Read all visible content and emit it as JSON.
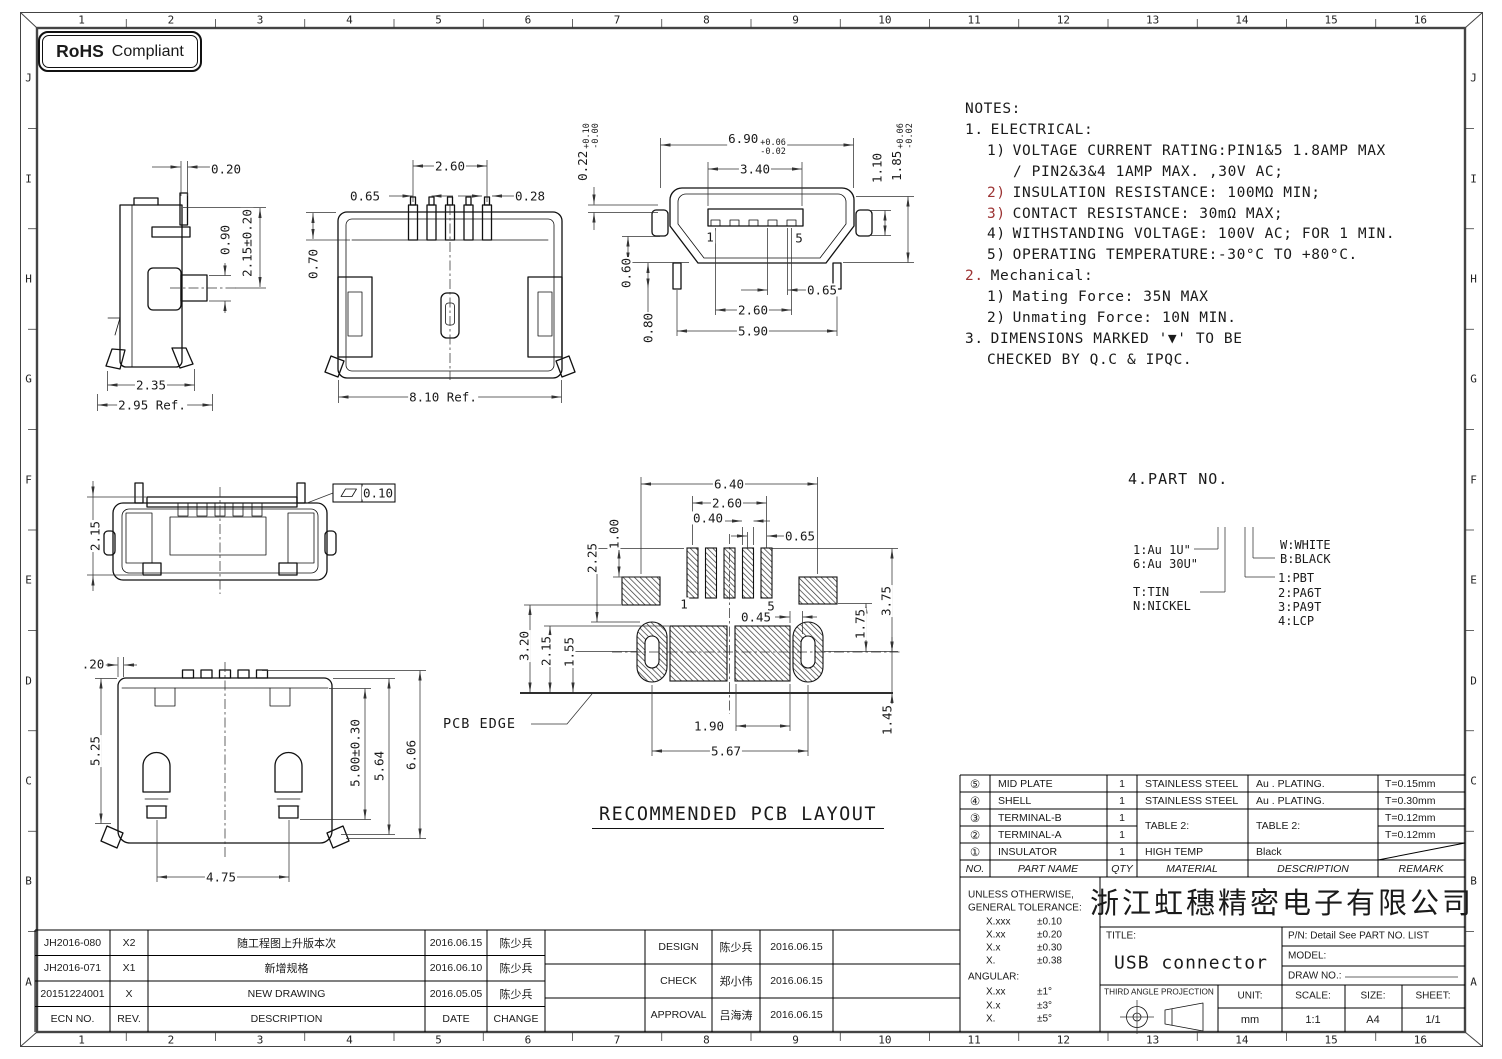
{
  "badge": {
    "brand": "RoHS",
    "label": "Compliant"
  },
  "grid": {
    "cols": [
      "1",
      "2",
      "3",
      "4",
      "5",
      "6",
      "7",
      "8",
      "9",
      "10",
      "11",
      "12",
      "13",
      "14",
      "15",
      "16"
    ],
    "rows": [
      "J",
      "I",
      "H",
      "G",
      "F",
      "E",
      "D",
      "C",
      "B",
      "A"
    ]
  },
  "notes": {
    "title": "NOTES:",
    "lines": [
      {
        "num": "1.",
        "text": "ELECTRICAL:"
      },
      {
        "num": "1)",
        "text": "VOLTAGE CURRENT RATING:PIN1&5 1.8AMP MAX"
      },
      {
        "num": "",
        "text": "/ PIN2&3&4 1AMP MAX. ,30V AC;"
      },
      {
        "num": "2)",
        "text": "INSULATION RESISTANCE: 100MΩ MIN;"
      },
      {
        "num": "3)",
        "text": "CONTACT RESISTANCE: 30mΩ MAX;"
      },
      {
        "num": "4)",
        "text": "WITHSTANDING VOLTAGE: 100V AC; FOR 1 MIN."
      },
      {
        "num": "5)",
        "text": "OPERATING TEMPERATURE:-30°C TO +80°C."
      },
      {
        "num": "2.",
        "text": "Mechanical:"
      },
      {
        "num": "1)",
        "text": "Mating Force:  35N MAX"
      },
      {
        "num": "2)",
        "text": "Unmating Force:  10N MIN."
      },
      {
        "num": "3.",
        "text": "DIMENSIONS MARKED '▼' TO BE"
      },
      {
        "num": "",
        "text": "CHECKED BY Q.C & IPQC."
      }
    ]
  },
  "legend": {
    "title": "4.PART NO.",
    "items_plating": [
      "1:Au 1U\"",
      "6:Au 30U\""
    ],
    "items_base": [
      "T:TIN",
      "N:NICKEL"
    ],
    "items_color": [
      "W:WHITE",
      "B:BLACK"
    ],
    "items_insulator": [
      "1:PBT",
      "2:PA6T",
      "3:PA9T",
      "4:LCP"
    ]
  },
  "pcb_title": "RECOMMENDED PCB LAYOUT",
  "dims": {
    "side": {
      "d020": "0.20",
      "d090": "0.90",
      "d215": "2.15±0.20",
      "d235": "2.35",
      "d295": "2.95 Ref."
    },
    "top": {
      "d260": "2.60",
      "d065": "0.65",
      "d028": "0.28",
      "d070": "0.70",
      "d810": "8.10 Ref."
    },
    "front": {
      "d022": "0.22",
      "d022p": "+0.10",
      "d022m": "-0.00",
      "d690": "6.90",
      "d690p": "+0.06",
      "d690m": "-0.02",
      "d340": "3.40",
      "d110": "1.10",
      "d185": "1.85",
      "d185p": "+0.06",
      "d185m": "-0.02",
      "d060": "0.60",
      "d080": "0.80",
      "d065": "0.65",
      "d260": "2.60",
      "d590": "5.90",
      "pin1": "1",
      "pin5": "5"
    },
    "rear": {
      "d215": "2.15",
      "tol": "0.10"
    },
    "pcb": {
      "d640": "6.40",
      "d260": "2.60",
      "d040": "0.40",
      "d065": "0.65",
      "d100": "1.00",
      "d225": "2.25",
      "d320": "3.20",
      "d215": "2.15",
      "d155": "1.55",
      "d045": "0.45",
      "d175": "1.75",
      "d375": "3.75",
      "d145": "1.45",
      "d190": "1.90",
      "d567": "5.67",
      "pin1": "1",
      "pin5": "5",
      "edge_label": "PCB EDGE"
    },
    "bottom": {
      "d020": ".20",
      "d525": "5.25",
      "d500": "5.00±0.30",
      "d564": "5.64",
      "d606": "6.06",
      "d475": "4.75"
    }
  },
  "parts_table": {
    "headers": {
      "no": "NO.",
      "name": "PART NAME",
      "qty": "QTY",
      "material": "MATERIAL",
      "desc": "DESCRIPTION",
      "remark": "REMARK"
    },
    "merged_material": "TABLE 2:",
    "merged_desc": "TABLE 2:",
    "rows": [
      {
        "no": "⑤",
        "name": "MID PLATE",
        "qty": "1",
        "material": "STAINLESS STEEL",
        "desc": "Au . PLATING.",
        "remark": "T=0.15mm"
      },
      {
        "no": "④",
        "name": "SHELL",
        "qty": "1",
        "material": "STAINLESS STEEL",
        "desc": "Au . PLATING.",
        "remark": "T=0.30mm"
      },
      {
        "no": "③",
        "name": "TERMINAL-B",
        "qty": "1",
        "material": "",
        "desc": "",
        "remark": "T=0.12mm"
      },
      {
        "no": "②",
        "name": "TERMINAL-A",
        "qty": "1",
        "material": "",
        "desc": "",
        "remark": "T=0.12mm"
      },
      {
        "no": "①",
        "name": "INSULATOR",
        "qty": "1",
        "material": "HIGH TEMP",
        "desc": "Black",
        "remark": ""
      }
    ]
  },
  "title_block": {
    "tolerance": {
      "l1": "UNLESS OTHERWISE,",
      "l2": "GENERAL TOLERANCE:",
      "rows": [
        [
          "X.xxx",
          "±0.10"
        ],
        [
          "X.xx",
          "±0.20"
        ],
        [
          "X.x",
          "±0.30"
        ],
        [
          "X.",
          "±0.38"
        ]
      ],
      "angular": "ANGULAR:",
      "angular_rows": [
        [
          "X.xx",
          "±1°"
        ],
        [
          "X.x",
          "±3°"
        ],
        [
          "X.",
          "±5°"
        ]
      ]
    },
    "company": "浙江虹穗精密电子有限公司",
    "title_label": "TITLE:",
    "title_value": "USB connector",
    "pn": "P/N: Detail See PART NO. LIST",
    "model_label": "MODEL:",
    "draw_no_label": "DRAW NO.:",
    "projection": "THIRD ANGLE PROJECTION",
    "unit_label": "UNIT:",
    "unit_value": "mm",
    "scale_label": "SCALE:",
    "scale_value": "1:1",
    "size_label": "SIZE:",
    "size_value": "A4",
    "sheet_label": "SHEET:",
    "sheet_value": "1/1"
  },
  "revisions": {
    "headers": {
      "ecn": "ECN NO.",
      "rev": "REV.",
      "desc": "DESCRIPTION",
      "date": "DATE",
      "change": "CHANGE"
    },
    "rows": [
      {
        "ecn": "JH2016-080",
        "rev": "X2",
        "desc": "随工程图上升版本次",
        "date": "2016.06.15",
        "by": "陈少兵"
      },
      {
        "ecn": "JH2016-071",
        "rev": "X1",
        "desc": "新增规格",
        "date": "2016.06.10",
        "by": "陈少兵"
      },
      {
        "ecn": "20151224001",
        "rev": "X",
        "desc": "NEW DRAWING",
        "date": "2016.05.05",
        "by": "陈少兵"
      }
    ]
  },
  "approvals": {
    "rows": [
      {
        "role": "DESIGN",
        "name": "陈少兵",
        "date": "2016.06.15"
      },
      {
        "role": "CHECK",
        "name": "郑小伟",
        "date": "2016.06.15"
      },
      {
        "role": "APPROVAL",
        "name": "吕海涛",
        "date": "2016.06.15"
      }
    ]
  }
}
